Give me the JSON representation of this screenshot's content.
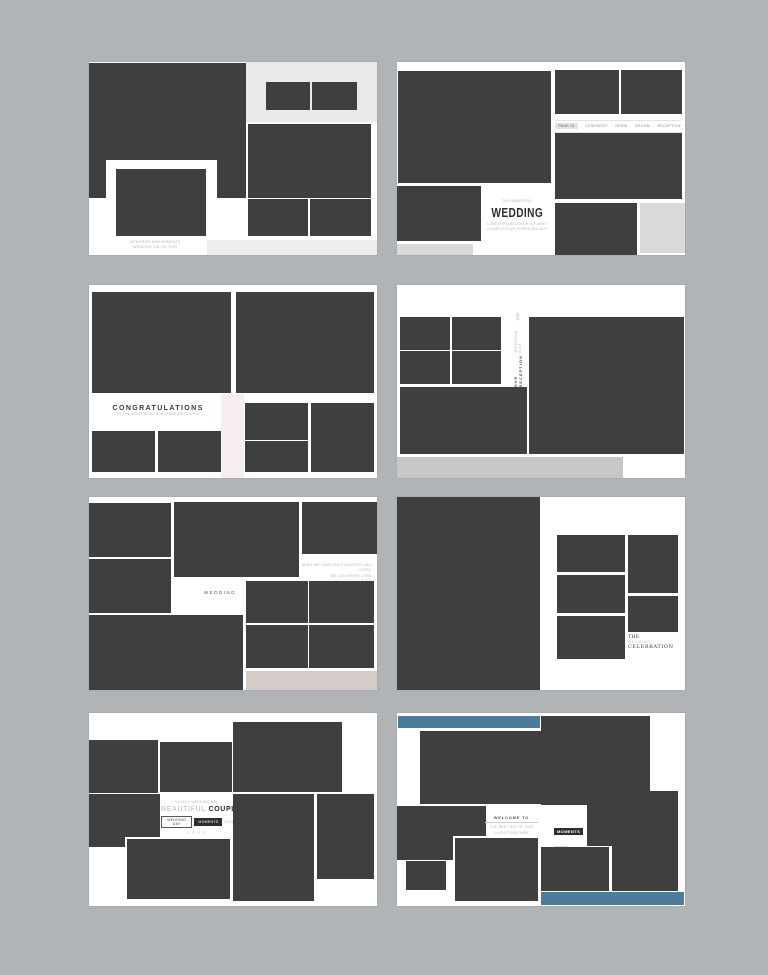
{
  "page": {
    "title": "Wedding photo album layout templates",
    "background_color": "#b1b4b7",
    "card_color": "#ffffff",
    "photo_placeholder_color": "#3f3f3f",
    "panel_gray": "#e9e9e9",
    "strip_gray": "#cdcdcd",
    "accent_pink": "#f7eef0",
    "accent_mauve": "#d5cbc8",
    "accent_blue": "#4b7c99"
  },
  "cards": [
    {
      "name": "template-1",
      "caption_line1": "MEMORIES AND MOMENTS",
      "caption_line2": "WEDDING COLLECTION"
    },
    {
      "name": "template-2",
      "kicker": "OUR BEAUTIFUL",
      "title": "WEDDING",
      "subtitle_line1": "LOREM IPSUM DOLOR SIT AMET",
      "subtitle_line2": "CONSECTETUR ADIPISCING ELIT",
      "menu_items": [
        "PAGE 01",
        "CEREMONY",
        "BRIDE",
        "GROOM",
        "RECEPTION"
      ]
    },
    {
      "name": "template-3",
      "title": "CONGRATULATIONS",
      "subtitle": "TO THE MOST BEAUTIFUL MARRIED COUPLE"
    },
    {
      "name": "template-4",
      "vertical_title": "OUR RECEPTION",
      "vertical_side": "WEDDING DAY",
      "vertical_small": "2023"
    },
    {
      "name": "template-5",
      "label": "WEDDING",
      "note_line1": "WHAT WE HAVE ONCE ENJOYED AND LOVED",
      "note_line2": "WE CAN NEVER LOSE",
      "note_line3": "E S T"
    },
    {
      "name": "template-6",
      "line1": "THE",
      "line2": "WEDDING",
      "line3": "CELEBRATION"
    },
    {
      "name": "template-7",
      "kicker": "LOVELY WEDDING DAY",
      "title_light": "BEAUTIFUL",
      "title_bold": "COUPLE",
      "chip_outline": "WEDDING DAY",
      "chip_solid": "MOMENTS",
      "chip_after": "2023",
      "footer": "L O V E"
    },
    {
      "name": "template-8",
      "welcome_title": "WELCOME TO",
      "welcome_sub": "THE BEST DAY OF OUR LIVES TOGETHER",
      "badge": "MOMENTS",
      "badge_after": "EST",
      "note_line1": "THE BEST THINGS IN LIFE ARE WORTH",
      "note_line2": "WAITING FOR ALWAYS"
    }
  ]
}
